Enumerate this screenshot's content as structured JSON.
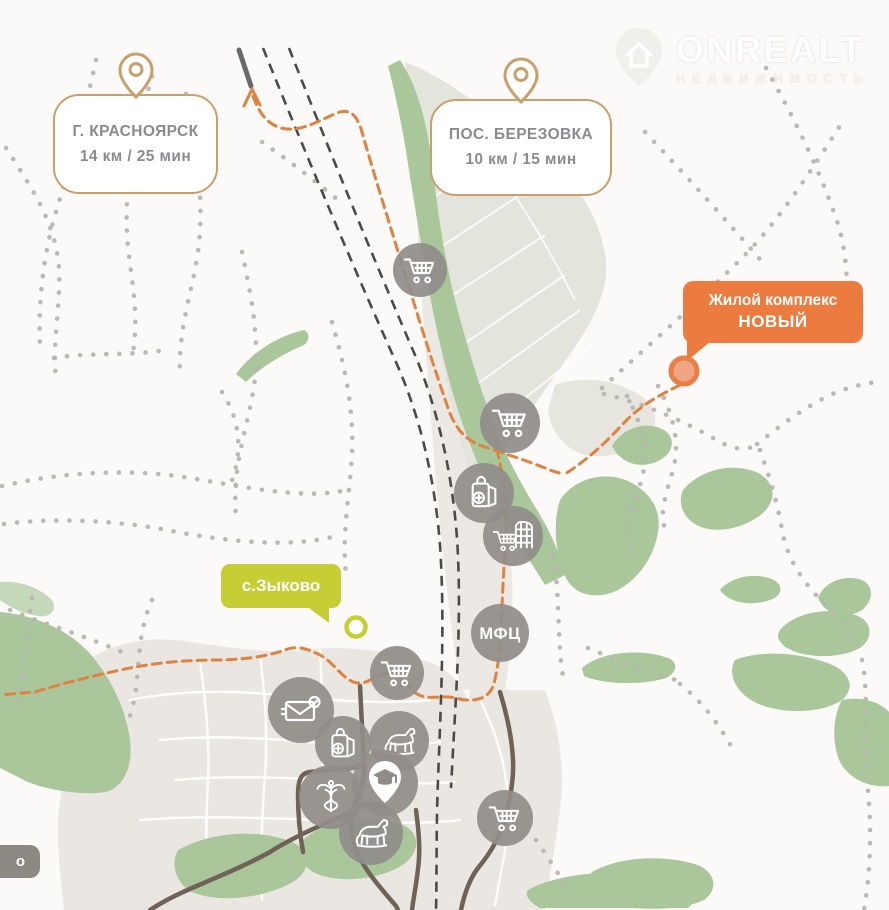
{
  "brand": {
    "name": "ONREALT",
    "tagline": "НЕДВИЖИМОСТЬ"
  },
  "callouts": [
    {
      "id": "krasnoyarsk",
      "title": "Г. КРАСНОЯРСК",
      "subtitle": "14 км / 25 мин"
    },
    {
      "id": "berezovka",
      "title": "ПОС. БЕРЕЗОВКА",
      "subtitle": "10 км / 15 мин"
    }
  ],
  "badges": {
    "complex": {
      "line1": "Жилой комплекс",
      "line2": "НОВЫЙ",
      "color": "#ec7b3f"
    },
    "village": {
      "label": "с.Зыково",
      "color": "#c6ce35"
    },
    "partial": {
      "label": "о",
      "color": "#8d8982"
    }
  },
  "map": {
    "mfc_label": "МФЦ",
    "poi_icons": [
      {
        "name": "supermarket-cart-icon"
      },
      {
        "name": "supermarket-cart-icon"
      },
      {
        "name": "grocery-bag-icon"
      },
      {
        "name": "market-building-cart-icon"
      },
      {
        "name": "mfc-circle"
      },
      {
        "name": "supermarket-cart-icon"
      },
      {
        "name": "post-office-icon"
      },
      {
        "name": "grocery-bag-icon"
      },
      {
        "name": "horse-stable-icon"
      },
      {
        "name": "education-pin-icon"
      },
      {
        "name": "medical-caduceus-icon"
      },
      {
        "name": "horse-stable-icon"
      },
      {
        "name": "supermarket-cart-icon"
      }
    ],
    "markers": [
      {
        "name": "complex-marker",
        "color": "#e87f44"
      },
      {
        "name": "village-marker",
        "color": "#c6ce35"
      }
    ]
  },
  "colors": {
    "background": "#fbfaf8",
    "route_orange": "#e0823f",
    "callout_border": "#c9a06b",
    "callout_text": "#8b8b8e",
    "railway": "#4c4946",
    "road_brown": "#6f6257",
    "forest_green": "#a9c79a",
    "poi_gray": "#918d8a",
    "trail_dots": "#b8b5b1",
    "settlement_beige": "#eae7e2",
    "fields_gray": "#e3e4db"
  }
}
